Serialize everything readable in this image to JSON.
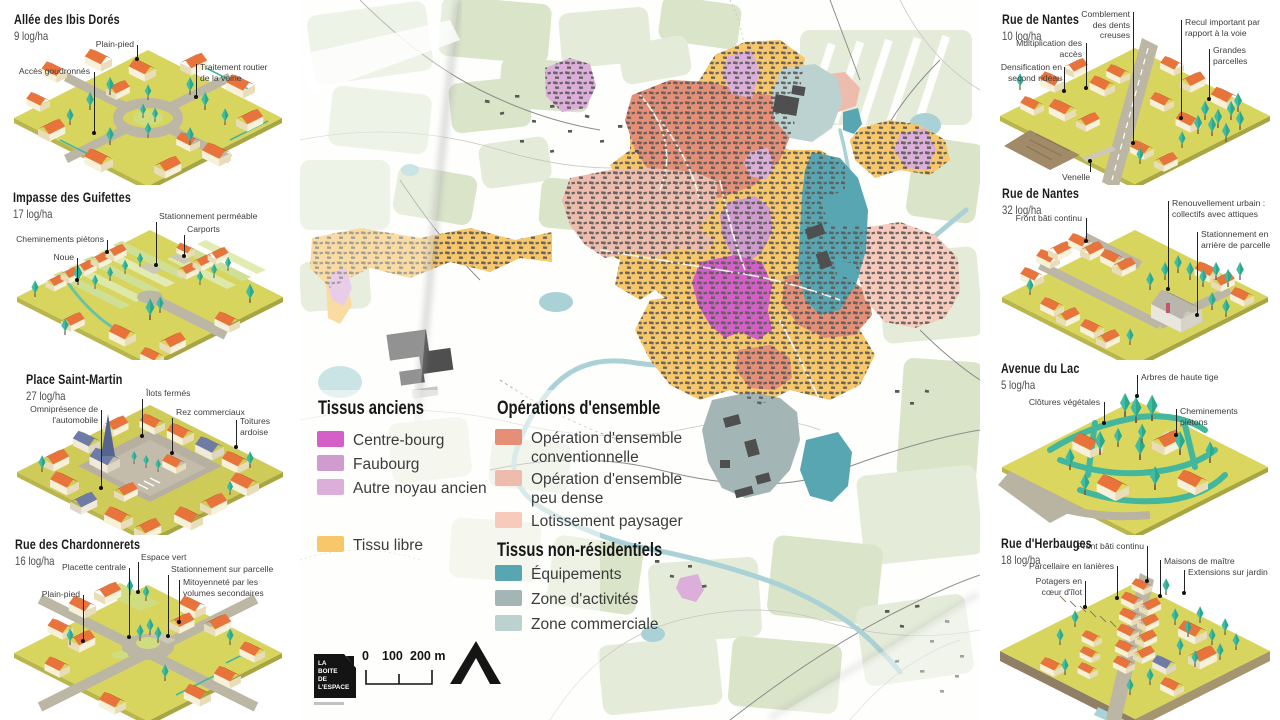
{
  "panels": {
    "left": [
      {
        "title": "Allée des Ibis Dorés",
        "density": "9 log/ha",
        "annotations": [
          {
            "label": "Plain-pied"
          },
          {
            "label": "Accès goudronnés"
          },
          {
            "label": "Traitement routier de la voirie"
          }
        ]
      },
      {
        "title": "Impasse des Guifettes",
        "density": "17 log/ha",
        "annotations": [
          {
            "label": "Stationnement perméable"
          },
          {
            "label": "Carports"
          },
          {
            "label": "Cheminements piétons"
          },
          {
            "label": "Noue"
          }
        ]
      },
      {
        "title": "Place Saint-Martin",
        "density": "27 log/ha",
        "annotations": [
          {
            "label": "Îlots fermés"
          },
          {
            "label": "Omniprésence de l'automobile"
          },
          {
            "label": "Rez commerciaux"
          },
          {
            "label": "Toitures ardoise"
          }
        ]
      },
      {
        "title": "Rue des Chardonnerets",
        "density": "16 log/ha",
        "annotations": [
          {
            "label": "Espace vert"
          },
          {
            "label": "Placette centrale"
          },
          {
            "label": "Stationnement sur parcelle"
          },
          {
            "label": "Mitoyenneté par les volumes secondaires"
          },
          {
            "label": "Plain-pied"
          }
        ]
      }
    ],
    "right": [
      {
        "title": "Rue de Nantes",
        "density": "10 log/ha",
        "annotations": [
          {
            "label": "Comblement des dents creuses"
          },
          {
            "label": "Recul important par rapport à la voie"
          },
          {
            "label": "Multiplication des accès"
          },
          {
            "label": "Grandes parcelles"
          },
          {
            "label": "Densification en second rideau"
          },
          {
            "label": "Venelle"
          }
        ]
      },
      {
        "title": "Rue de Nantes",
        "density": "32 log/ha",
        "annotations": [
          {
            "label": "Renouvellement urbain : collectifs avec attiques"
          },
          {
            "label": "Front bâti continu"
          },
          {
            "label": "Stationnement en arrière de parcelle"
          }
        ]
      },
      {
        "title": "Avenue du Lac",
        "density": "5 log/ha",
        "annotations": [
          {
            "label": "Arbres de haute tige"
          },
          {
            "label": "Clôtures végétales"
          },
          {
            "label": "Cheminements piétons"
          }
        ]
      },
      {
        "title": "Rue d'Herbauges",
        "density": "18 log/ha",
        "annotations": [
          {
            "label": "Front bâti continu"
          },
          {
            "label": "Maisons de maître"
          },
          {
            "label": "Extensions sur jardin"
          },
          {
            "label": "Parcellaire en lanières"
          },
          {
            "label": "Potagers en cœur d'îlot"
          }
        ]
      }
    ]
  },
  "legend": {
    "groups": [
      {
        "title": "Tissus anciens",
        "items": [
          {
            "label": "Centre-bourg",
            "color": "#d45fc7"
          },
          {
            "label": "Faubourg",
            "color": "#d09bce"
          },
          {
            "label": "Autre noyau ancien",
            "color": "#dcaeda"
          },
          {
            "label": "Tissu libre",
            "color": "#f7c76a"
          }
        ]
      },
      {
        "title": "Opérations d'ensemble",
        "items": [
          {
            "label": "Opération d'ensemble conventionnelle",
            "color": "#e68f77"
          },
          {
            "label": "Opération d'ensemble peu dense",
            "color": "#eebcad"
          },
          {
            "label": "Lotissement paysager",
            "color": "#f7cabb"
          }
        ]
      },
      {
        "title": "Tissus non-résidentiels",
        "items": [
          {
            "label": "Équipements",
            "color": "#57a6b2"
          },
          {
            "label": "Zone d'activités",
            "color": "#a3b6b5"
          },
          {
            "label": "Zone commerciale",
            "color": "#bcd2d0"
          }
        ]
      }
    ]
  },
  "footer": {
    "scale_ticks": [
      "0",
      "100",
      "200 m"
    ],
    "logo_lines": [
      "LA",
      "BOITE",
      "DE",
      "L'ESPACE"
    ]
  },
  "colors": {
    "ground": "#d8d55f",
    "roof": "#e8743c",
    "roof_dark": "#c75526",
    "wall": "#f8f1da",
    "tree": "#3fbda4",
    "road": "#bcb6a5",
    "river": "#aad2d6",
    "field_green": "#e4ecd9"
  }
}
